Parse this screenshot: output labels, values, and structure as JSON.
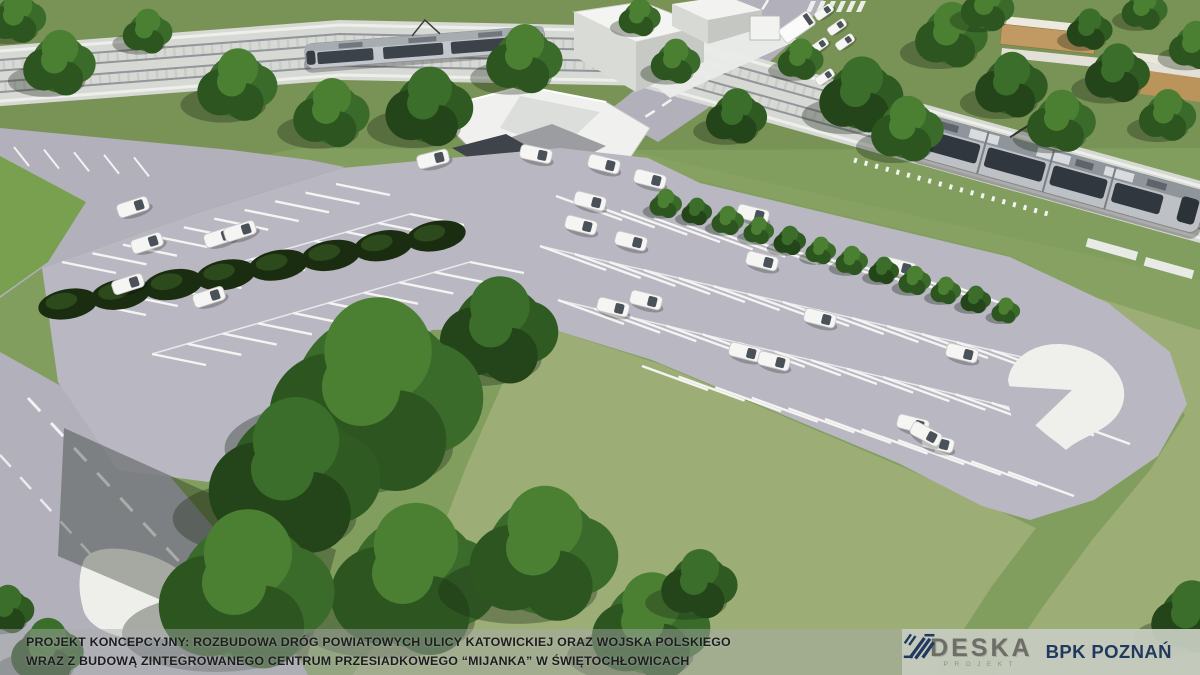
{
  "caption": {
    "line1": "PROJEKT KONCEPCYJNY: ROZBUDOWA DRÓG POWIATOWYCH ULICY KATOWICKIEJ ORAZ WOJSKA POLSKIEGO",
    "line2": "WRAZ Z BUDOWĄ ZINTEGROWANEGO CENTRUM PRZESIADKOWEGO “MIJANKA” W ŚWIĘTOCHŁOWICACH"
  },
  "branding": {
    "deska": {
      "title": "DESKA",
      "subtitle": "PROJEKT"
    },
    "bpk": {
      "title": "BPK POZNAŃ"
    }
  },
  "colors": {
    "grass": "#819e5e",
    "grass_top": "#789355",
    "grass_strip": "#86a162",
    "field": "#9cad76",
    "road": "#b1b0bb",
    "asphalt": "#b8b7c2",
    "ballast": "#d7d9d5",
    "rail": "#92959a",
    "rail_edge": "#edefeb",
    "concrete": "#f0f1ee",
    "tunnel": "#3f444a",
    "hedge": "#1a2d11",
    "tram_body": "#bdc1c6",
    "car_white": "#f5f5f4",
    "caption_text": "#1d1d20",
    "logo_panel_bg": "#c6ccbf",
    "deska_gray": "#6e6e68",
    "bpk_navy": "#21395e"
  }
}
